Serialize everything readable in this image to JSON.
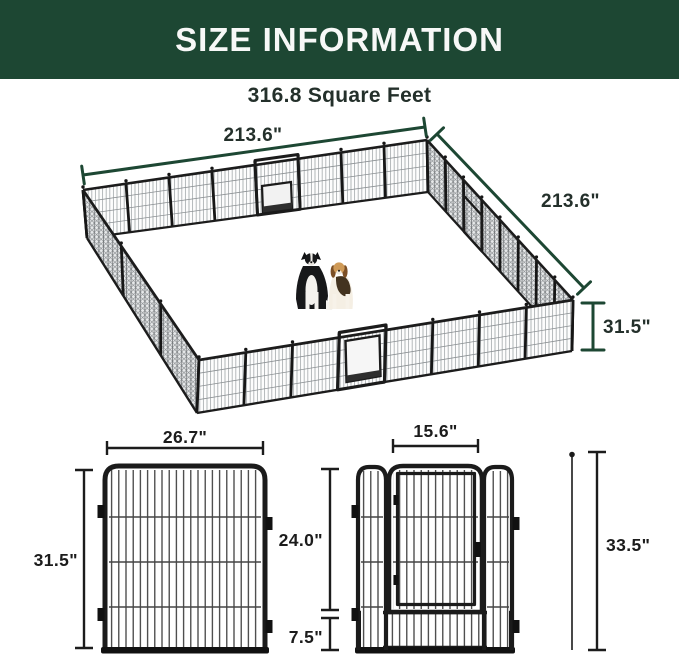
{
  "header": {
    "title": "SIZE INFORMATION",
    "subtitle": "316.8 Square Feet"
  },
  "isometric": {
    "top_width_label": "213.6\"",
    "right_depth_label": "213.6\"",
    "height_label": "31.5\""
  },
  "panel_detail": {
    "panel_width_label": "26.7\"",
    "panel_height_label": "31.5\"",
    "door_width_label": "15.6\"",
    "door_height_label": "24.0\"",
    "gate_bottom_label": "7.5\"",
    "stake_length_label": "33.5\""
  },
  "colors": {
    "header_bg": "#1d4733",
    "dimension_green": "#1d4733",
    "label_dark": "#24302b",
    "line_black": "#1c1c1c"
  }
}
